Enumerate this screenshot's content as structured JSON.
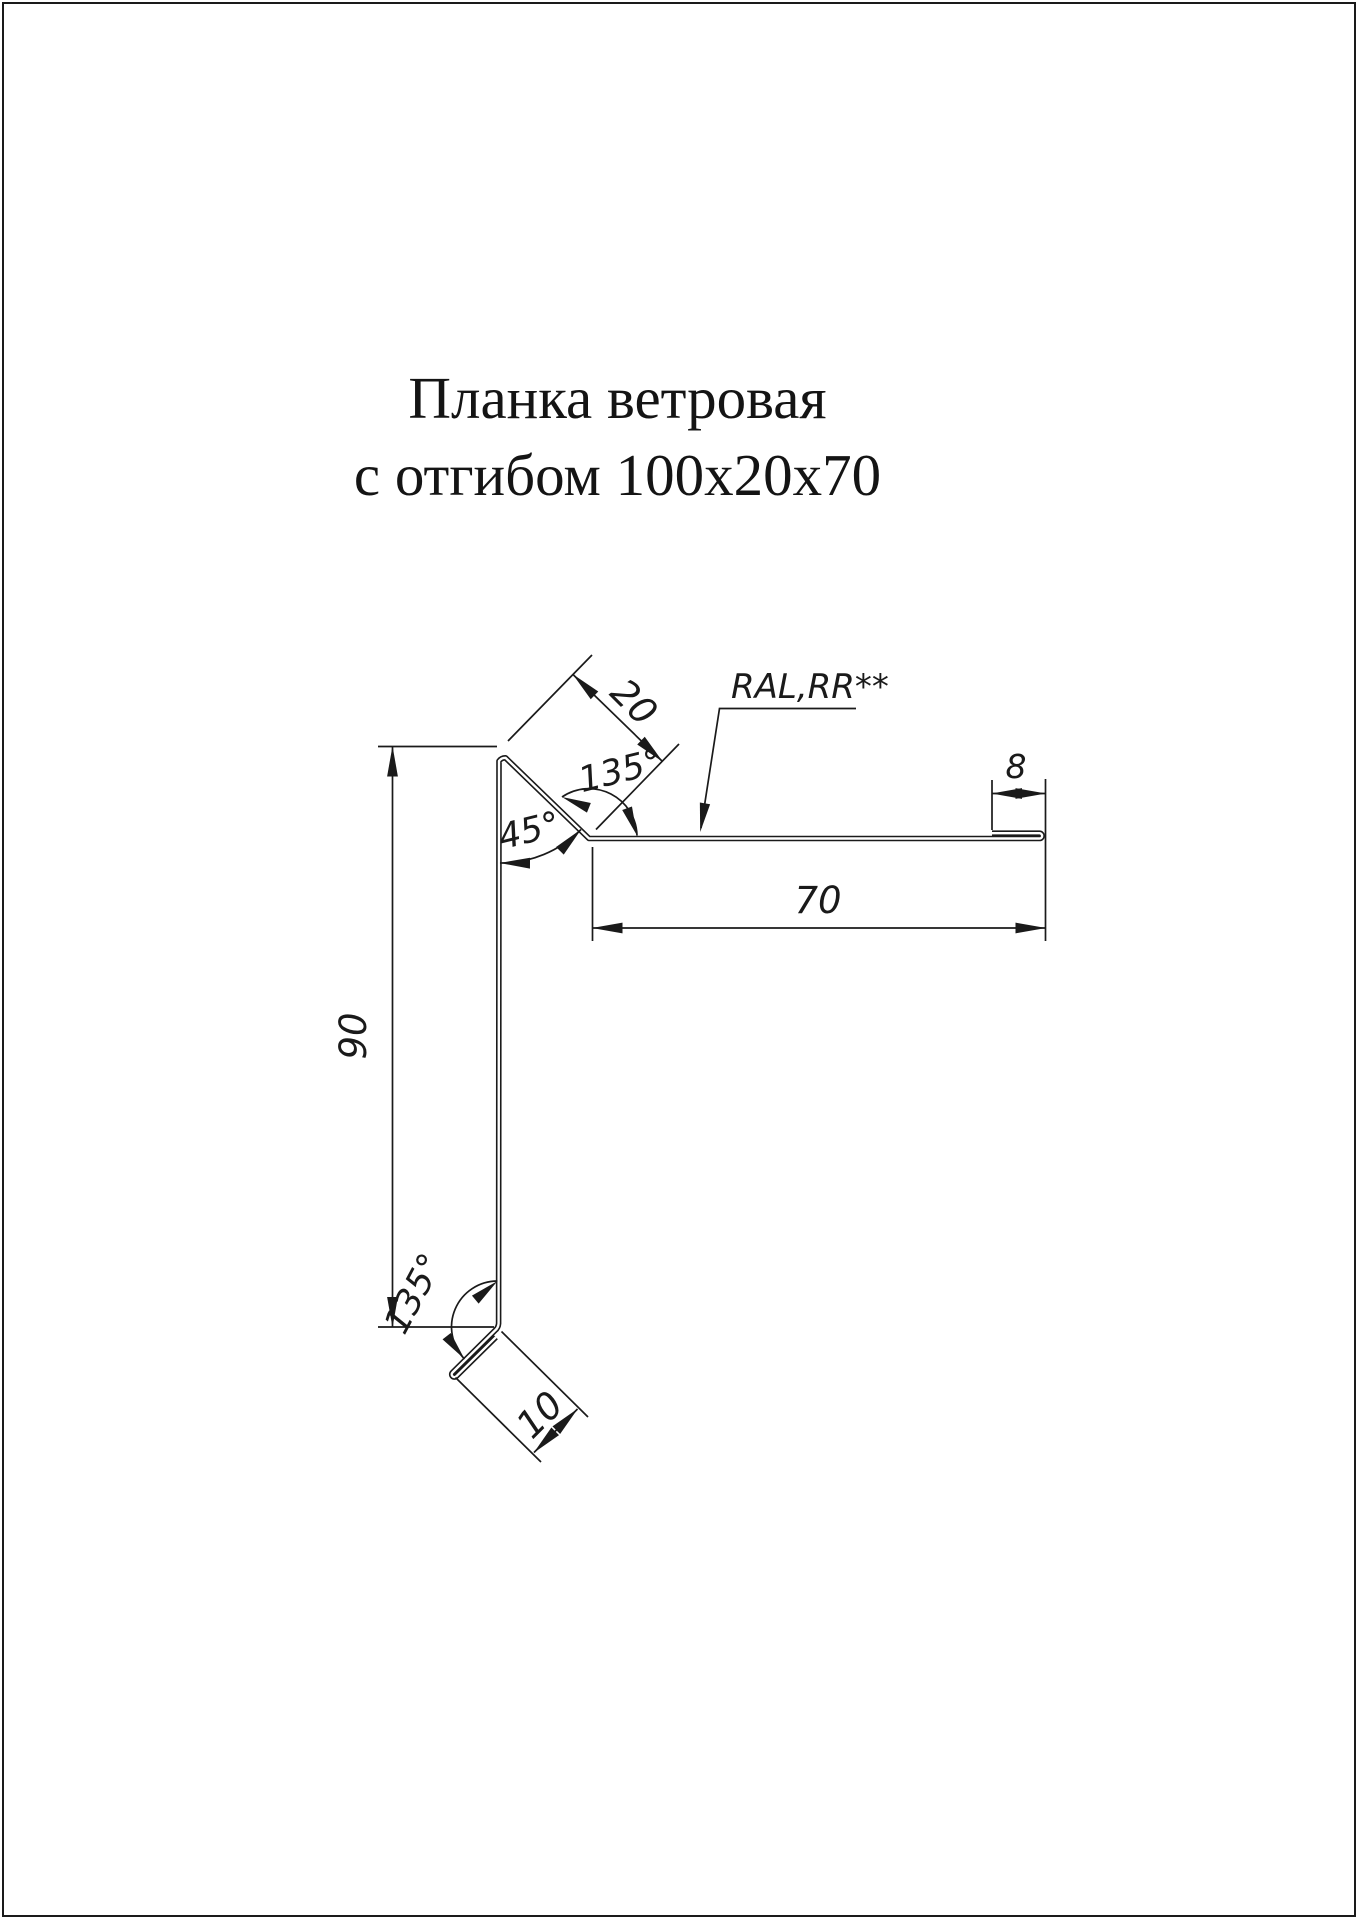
{
  "page": {
    "background": "#ffffff",
    "frame_color": "#1a1a1a",
    "line_color": "#1a1a1a"
  },
  "title": {
    "line1": "Планка ветровая",
    "line2": "с отгибом 100х20х70"
  },
  "dimensions": {
    "fold_top_length": "20",
    "angle_top": "135°",
    "angle_bend": "45°",
    "coating_note": "RAL,RR**",
    "hem_right": "8",
    "shelf_top": "70",
    "height_left": "90",
    "angle_bottom": "135°",
    "fold_bottom": "10"
  }
}
